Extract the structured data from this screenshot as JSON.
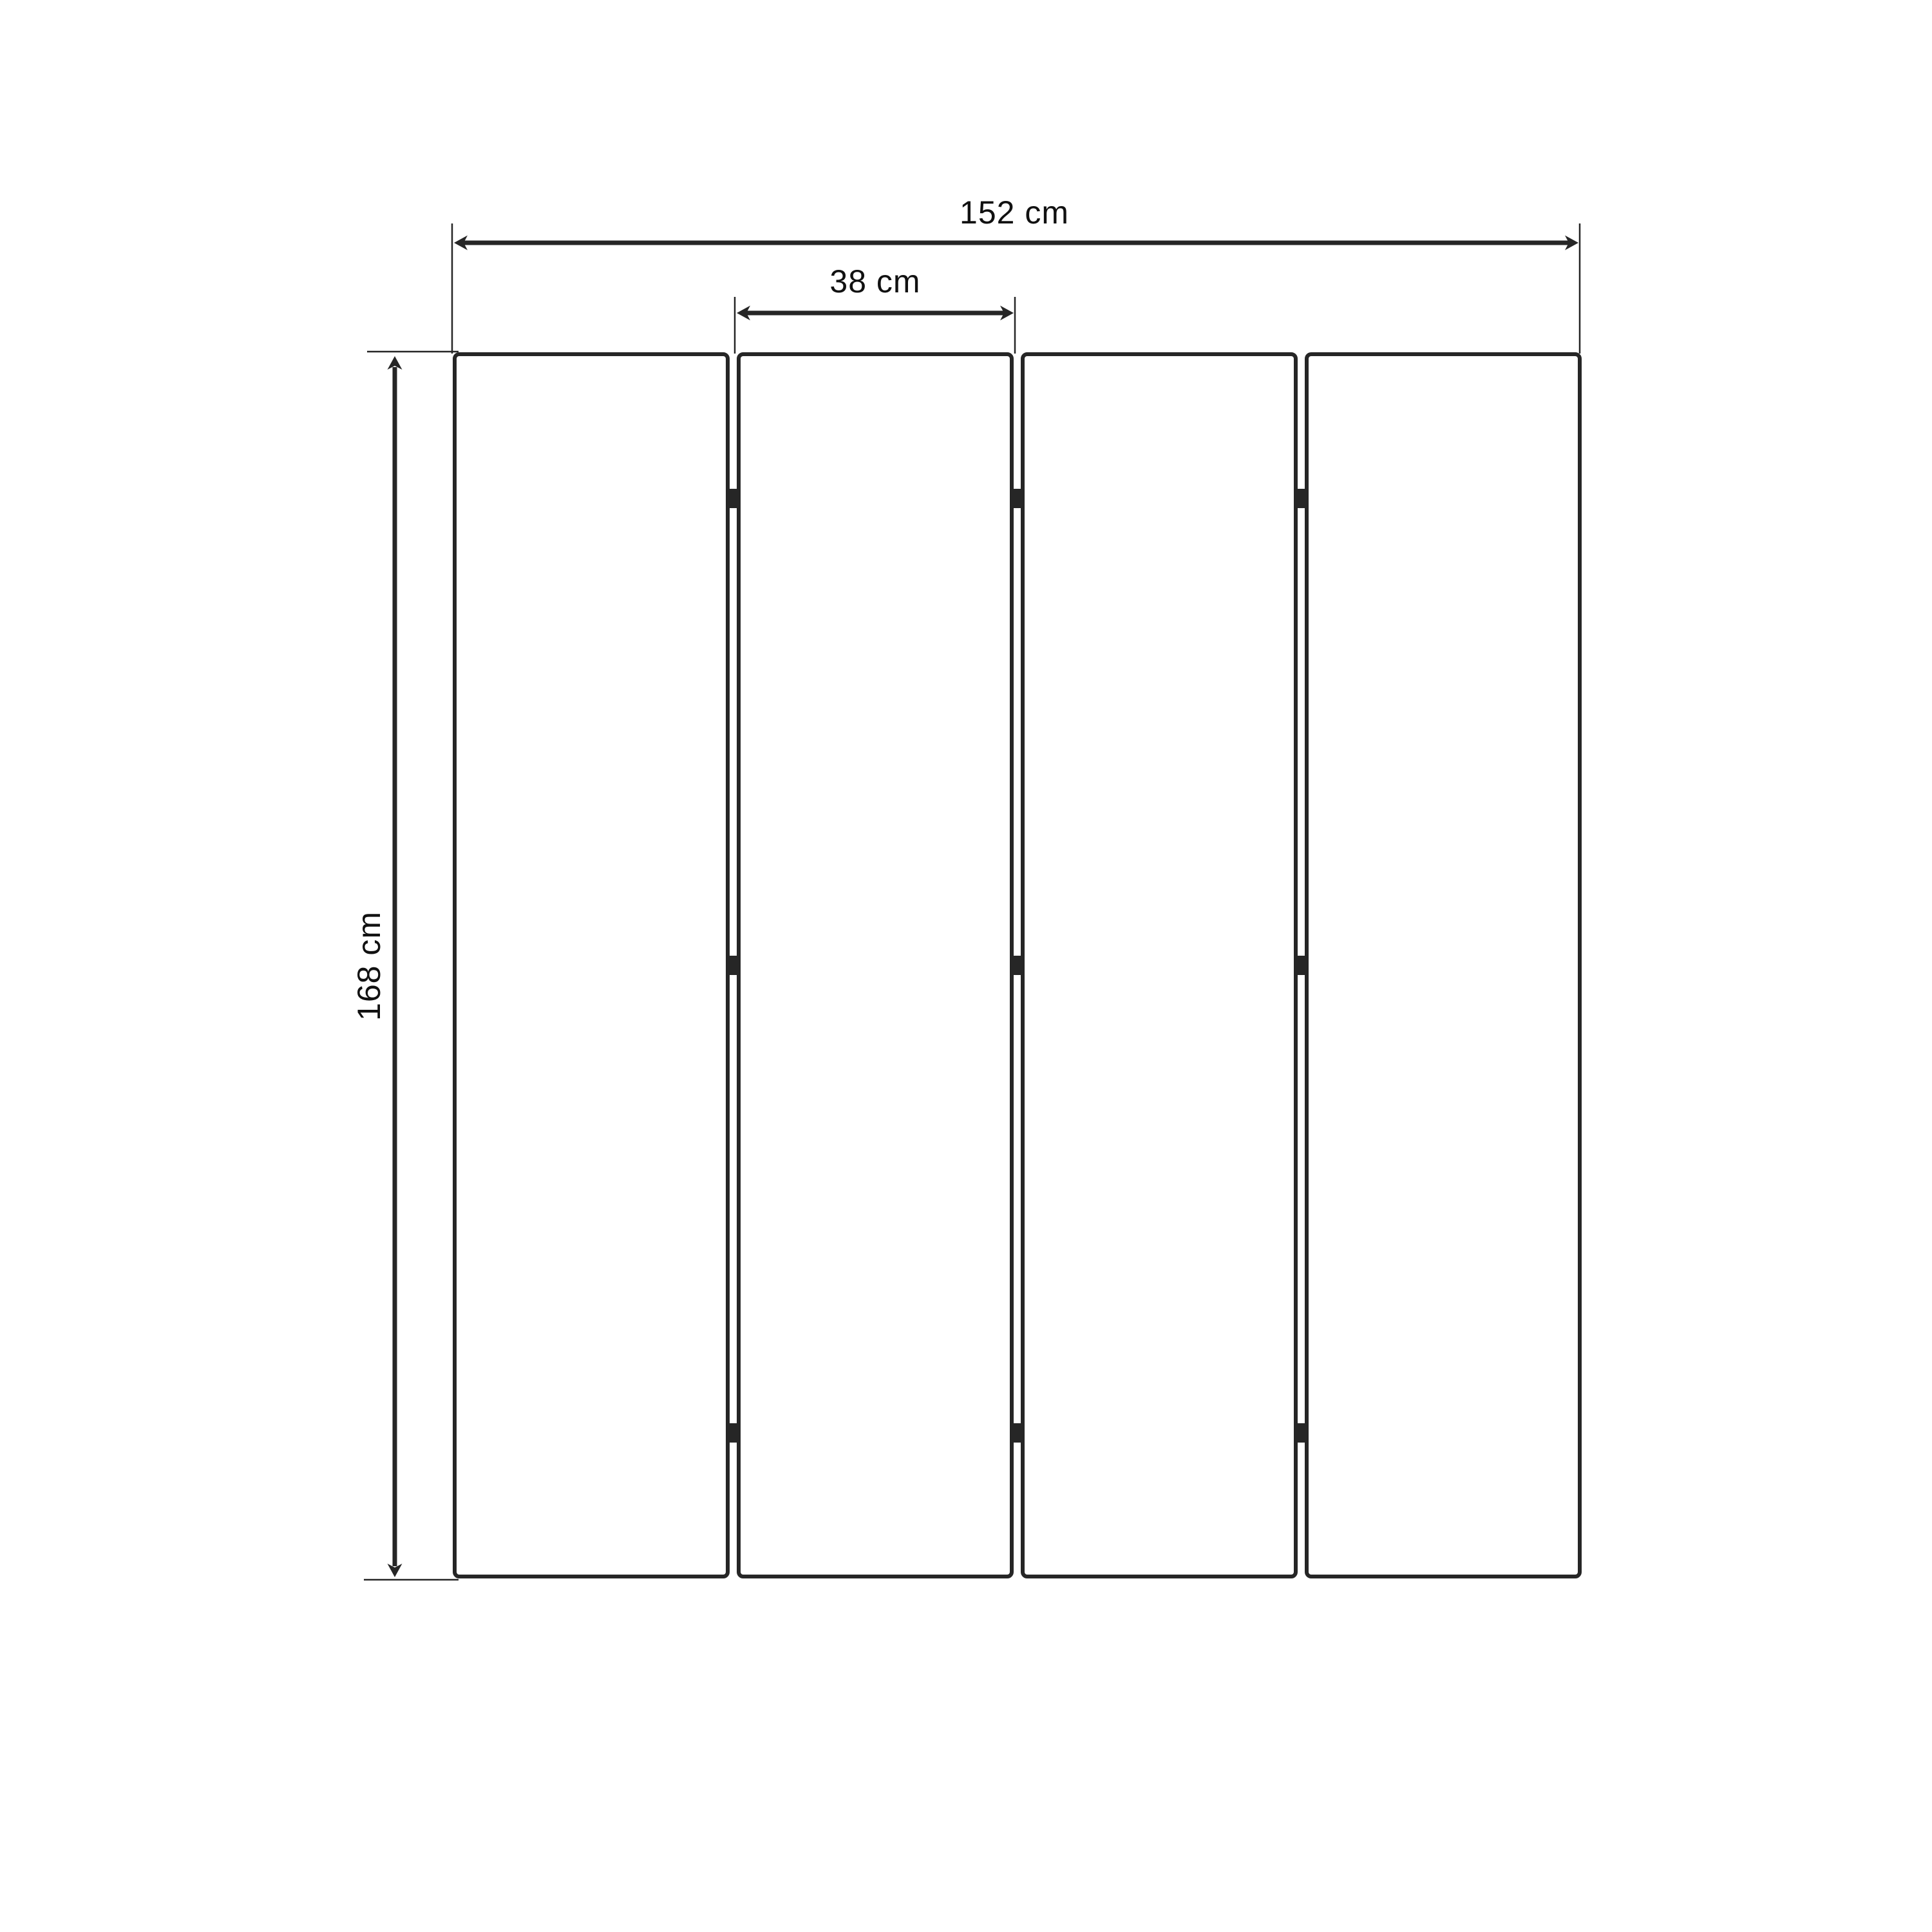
{
  "diagram": {
    "type": "technical-dimension-drawing",
    "subject": "four-panel folding screen, front elevation",
    "panel_count": 4,
    "hinge_rows_per_joint": 3,
    "dimensions": {
      "total_width": {
        "label": "152 cm",
        "value": 152,
        "unit": "cm"
      },
      "panel_width": {
        "label": "38 cm",
        "value": 38,
        "unit": "cm"
      },
      "height": {
        "label": "168 cm",
        "value": 168,
        "unit": "cm"
      }
    },
    "colors": {
      "line": "#262626",
      "text": "#111111",
      "background": "#ffffff"
    }
  }
}
